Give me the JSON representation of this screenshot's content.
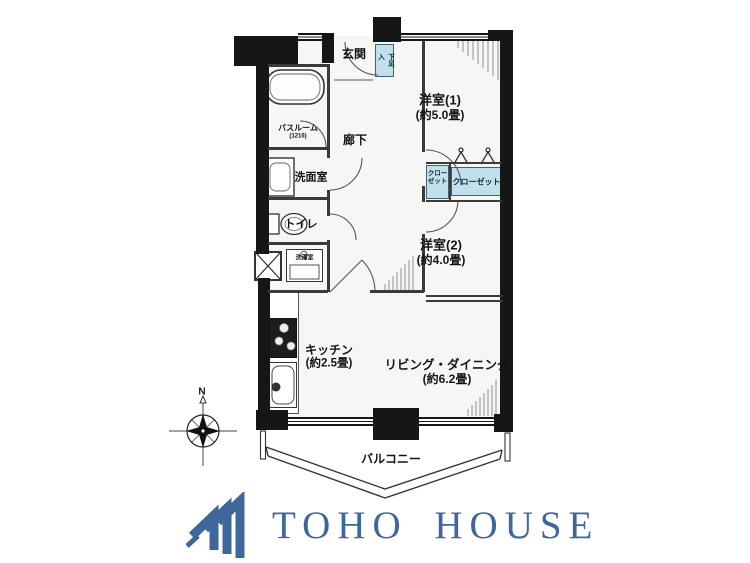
{
  "plan": {
    "entrance_label": "玄関",
    "shoe_cabinet_label": "下足入",
    "hallway_label": "廊下",
    "bathroom_label": "バスルーム",
    "bathroom_size": "(1216)",
    "washroom_label": "洗面室",
    "toilet_label": "トイレ",
    "laundry_label": "洗濯室",
    "closet_small_line1": "クロー",
    "closet_small_line2": "ゼット",
    "closet_large_label": "クローゼット",
    "western_room1_label": "洋室(1)",
    "western_room1_size": "(約5.0畳)",
    "western_room2_label": "洋室(2)",
    "western_room2_size": "(約4.0畳)",
    "kitchen_label": "キッチン",
    "kitchen_size": "(約2.5畳)",
    "living_dining_label": "リビング・ダイニング",
    "living_dining_size": "(約6.2畳)",
    "balcony_label": "バルコニー",
    "compass_north": "N"
  },
  "branding": {
    "company_name": "TOHO HOUSE"
  },
  "colors": {
    "logo_blue": "#40679b",
    "storage_blue": "#bfe0ec",
    "wall_black": "#161616"
  }
}
